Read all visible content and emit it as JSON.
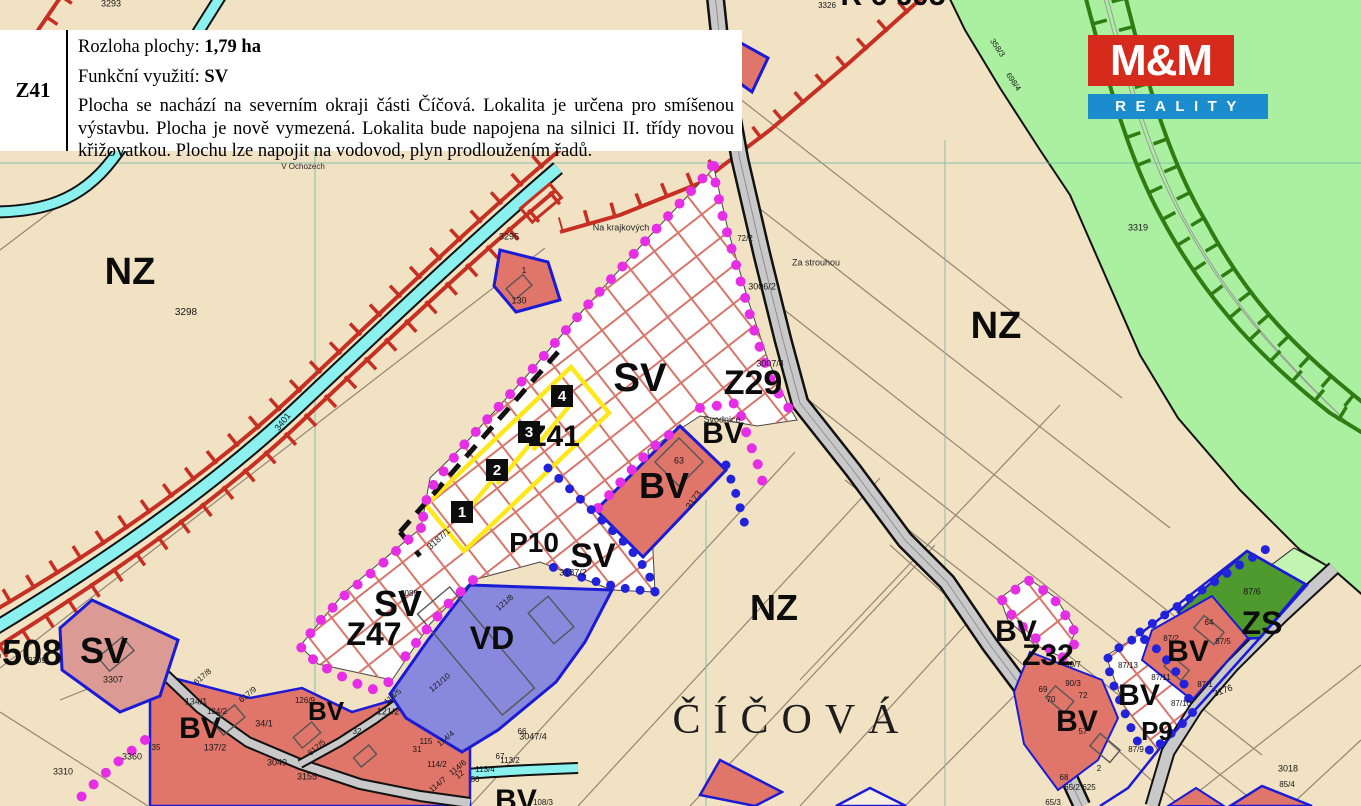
{
  "info_panel": {
    "code": "Z41",
    "area_label": "Rozloha plochy:",
    "area_value": "1,79 ha",
    "use_label": "Funkční využití:",
    "use_value": "SV",
    "desc_lines": [
      "Plocha se nachází na severním okraji části Číčová. Lokalita je určena pro smíšenou",
      "výstavbu. Plocha je nově vymezená. Lokalita bude napojena na silnici II. třídy novou",
      "křižovatkou. Plochu lze napojit na vodovod, plyn prodloužením řadů."
    ]
  },
  "logo": {
    "top": "M&M",
    "bottom": "REALITY",
    "red": "#d62a1c",
    "blue": "#1b8ccd"
  },
  "map": {
    "colors": {
      "background": "#f2e2c4",
      "green_zone": "#abf0a0",
      "zs_green": "#4f9a2e",
      "stream": "#8af1ef",
      "biocorridor_red": "#c62f22",
      "railway_green": "#2e7c12",
      "road_gray": "#c9c9c9",
      "parcel_red": "#e0756a",
      "parcel_pink": "#db9a94",
      "vd_purple": "#8888dd",
      "outline_blue": "#1b1bd6",
      "dots_magenta": "#e62ee6",
      "dots_blue": "#2222dd",
      "plot_yellow": "#ffe81a",
      "hatch_red": "#d7766b"
    },
    "zone_labels": [
      {
        "text": "NZ",
        "x": 130,
        "y": 272,
        "size": 38,
        "name": "zone-label-nz-west"
      },
      {
        "text": "NZ",
        "x": 996,
        "y": 326,
        "size": 38,
        "name": "zone-label-nz-east"
      },
      {
        "text": "NZ",
        "x": 774,
        "y": 608,
        "size": 36,
        "name": "zone-label-nz-south"
      },
      {
        "text": "SV",
        "x": 640,
        "y": 378,
        "size": 40,
        "name": "zone-label-sv-main"
      },
      {
        "text": "Z29",
        "x": 753,
        "y": 383,
        "size": 34,
        "name": "zone-label-z29"
      },
      {
        "text": "Z41",
        "x": 554,
        "y": 437,
        "size": 30,
        "name": "zone-label-z41"
      },
      {
        "text": "BV",
        "x": 723,
        "y": 434,
        "size": 30,
        "name": "zone-label-bv-svodnice"
      },
      {
        "text": "BV",
        "x": 664,
        "y": 486,
        "size": 36,
        "name": "zone-label-bv-center"
      },
      {
        "text": "P10",
        "x": 534,
        "y": 543,
        "size": 28,
        "name": "zone-label-p10"
      },
      {
        "text": "SV",
        "x": 593,
        "y": 556,
        "size": 34,
        "name": "zone-label-sv-p10"
      },
      {
        "text": "SV",
        "x": 398,
        "y": 604,
        "size": 36,
        "name": "zone-label-sv-z47"
      },
      {
        "text": "Z47",
        "x": 374,
        "y": 634,
        "size": 32,
        "name": "zone-label-z47"
      },
      {
        "text": "SV",
        "x": 104,
        "y": 651,
        "size": 36,
        "name": "zone-label-sv-west"
      },
      {
        "text": "-508",
        "x": 26,
        "y": 653,
        "size": 36,
        "name": "zone-label-508"
      },
      {
        "text": "BV",
        "x": 200,
        "y": 729,
        "size": 30,
        "name": "zone-label-bv-village-w"
      },
      {
        "text": "BV",
        "x": 326,
        "y": 711,
        "size": 26,
        "name": "zone-label-bv-village-e"
      },
      {
        "text": "BV",
        "x": 516,
        "y": 801,
        "size": 30,
        "name": "zone-label-bv-bottom"
      },
      {
        "text": "VD",
        "x": 492,
        "y": 638,
        "size": 32,
        "name": "zone-label-vd"
      },
      {
        "text": "BV",
        "x": 1016,
        "y": 632,
        "size": 30,
        "name": "zone-label-bv-z32"
      },
      {
        "text": "Z32",
        "x": 1048,
        "y": 656,
        "size": 30,
        "name": "zone-label-z32"
      },
      {
        "text": "BV",
        "x": 1139,
        "y": 696,
        "size": 30,
        "name": "zone-label-bv-p9"
      },
      {
        "text": "BV",
        "x": 1188,
        "y": 652,
        "size": 30,
        "name": "zone-label-bv-east"
      },
      {
        "text": "BV",
        "x": 1077,
        "y": 722,
        "size": 30,
        "name": "zone-label-bv-se"
      },
      {
        "text": "ZS",
        "x": 1262,
        "y": 623,
        "size": 32,
        "name": "zone-label-zs"
      },
      {
        "text": "P9",
        "x": 1157,
        "y": 731,
        "size": 26,
        "name": "zone-label-p9"
      },
      {
        "text": "R 6 605",
        "x": 893,
        "y": -4,
        "size": 30,
        "name": "zone-label-corridor"
      }
    ],
    "place_labels": [
      {
        "text": "ČÍČOVÁ",
        "x": 792,
        "y": 720,
        "size": 42,
        "cls": "town",
        "name": "town-label-cicova"
      },
      {
        "text": "Svodnice",
        "x": 722,
        "y": 420,
        "size": 9,
        "cls": "place",
        "name": "place-label-svodnice"
      },
      {
        "text": "Na krajkových",
        "x": 621,
        "y": 228,
        "size": 9,
        "cls": "place",
        "name": "place-label-na-krajkovych"
      },
      {
        "text": "Za strouhou",
        "x": 816,
        "y": 263,
        "size": 9,
        "cls": "place",
        "name": "place-label-za-strouhou"
      },
      {
        "text": "V Ochozech",
        "x": 303,
        "y": 167,
        "size": 8,
        "cls": "place",
        "name": "place-label-v-ochozech"
      }
    ],
    "parcel_numbers": [
      {
        "text": "3293",
        "x": 111,
        "y": 4
      },
      {
        "text": "3298",
        "x": 186,
        "y": 313,
        "size": 10
      },
      {
        "text": "3401",
        "x": 283,
        "y": 422,
        "rot": -52
      },
      {
        "text": "3295",
        "x": 509,
        "y": 237
      },
      {
        "text": "1",
        "x": 524,
        "y": 271,
        "size": 8
      },
      {
        "text": "130",
        "x": 519,
        "y": 301
      },
      {
        "text": "72/2",
        "x": 745,
        "y": 239,
        "size": 8
      },
      {
        "text": "3006/2",
        "x": 762,
        "y": 287
      },
      {
        "text": "3007/4",
        "x": 770,
        "y": 364
      },
      {
        "text": "63",
        "x": 679,
        "y": 461
      },
      {
        "text": "3187/2",
        "x": 573,
        "y": 573
      },
      {
        "text": "3187/1",
        "x": 439,
        "y": 539,
        "rot": -42
      },
      {
        "text": "3085",
        "x": 409,
        "y": 594,
        "size": 8
      },
      {
        "text": "3173",
        "x": 694,
        "y": 500,
        "rot": -55
      },
      {
        "text": "3309",
        "x": 37,
        "y": 661,
        "size": 8
      },
      {
        "text": "3307",
        "x": 113,
        "y": 680
      },
      {
        "text": "3310",
        "x": 63,
        "y": 772
      },
      {
        "text": "3360",
        "x": 132,
        "y": 757
      },
      {
        "text": "35",
        "x": 156,
        "y": 748,
        "size": 8
      },
      {
        "text": "134/1",
        "x": 196,
        "y": 702
      },
      {
        "text": "134/2",
        "x": 217,
        "y": 712,
        "size": 8
      },
      {
        "text": "34/1",
        "x": 264,
        "y": 724
      },
      {
        "text": "137/2",
        "x": 215,
        "y": 748
      },
      {
        "text": "3049",
        "x": 277,
        "y": 763
      },
      {
        "text": "126/9",
        "x": 305,
        "y": 701,
        "size": 8
      },
      {
        "text": "121/2",
        "x": 388,
        "y": 712
      },
      {
        "text": "32",
        "x": 357,
        "y": 732,
        "size": 8
      },
      {
        "text": "617/8",
        "x": 203,
        "y": 677,
        "rot": -40,
        "size": 8
      },
      {
        "text": "617/9",
        "x": 248,
        "y": 695,
        "rot": -40,
        "size": 8
      },
      {
        "text": "617/5",
        "x": 317,
        "y": 748,
        "rot": -40,
        "size": 8
      },
      {
        "text": "115",
        "x": 426,
        "y": 742,
        "size": 8
      },
      {
        "text": "31",
        "x": 417,
        "y": 750,
        "size": 8
      },
      {
        "text": "114/4",
        "x": 446,
        "y": 739,
        "rot": -40,
        "size": 8
      },
      {
        "text": "114/5",
        "x": 393,
        "y": 697,
        "rot": -40,
        "size": 8
      },
      {
        "text": "114/2",
        "x": 437,
        "y": 765,
        "size": 8
      },
      {
        "text": "114/6",
        "x": 458,
        "y": 768,
        "rot": -40,
        "size": 8
      },
      {
        "text": "114/7",
        "x": 438,
        "y": 785,
        "rot": -40,
        "size": 8
      },
      {
        "text": "12",
        "x": 460,
        "y": 775,
        "rot": -40,
        "size": 8
      },
      {
        "text": "30",
        "x": 475,
        "y": 780,
        "size": 8
      },
      {
        "text": "113/2",
        "x": 510,
        "y": 761,
        "size": 8
      },
      {
        "text": "113/4",
        "x": 485,
        "y": 770,
        "size": 8
      },
      {
        "text": "66",
        "x": 522,
        "y": 732,
        "size": 8
      },
      {
        "text": "67",
        "x": 500,
        "y": 757,
        "size": 8
      },
      {
        "text": "3047/4",
        "x": 533,
        "y": 737
      },
      {
        "text": "108/3",
        "x": 543,
        "y": 803,
        "size": 8
      },
      {
        "text": "121/8",
        "x": 505,
        "y": 603,
        "rot": -40,
        "size": 8
      },
      {
        "text": "121/10",
        "x": 440,
        "y": 683,
        "rot": -40,
        "size": 8
      },
      {
        "text": "3155",
        "x": 307,
        "y": 777
      },
      {
        "text": "90/7",
        "x": 1073,
        "y": 665,
        "size": 8
      },
      {
        "text": "90/3",
        "x": 1073,
        "y": 684,
        "size": 8
      },
      {
        "text": "69",
        "x": 1043,
        "y": 690,
        "size": 8
      },
      {
        "text": "70",
        "x": 1051,
        "y": 700,
        "size": 8
      },
      {
        "text": "72",
        "x": 1083,
        "y": 696,
        "size": 8
      },
      {
        "text": "57",
        "x": 1083,
        "y": 732,
        "size": 8
      },
      {
        "text": "2",
        "x": 1099,
        "y": 769,
        "size": 8
      },
      {
        "text": "68",
        "x": 1064,
        "y": 778,
        "size": 8
      },
      {
        "text": "87/13",
        "x": 1128,
        "y": 666,
        "size": 8
      },
      {
        "text": "87/11",
        "x": 1161,
        "y": 678,
        "size": 8
      },
      {
        "text": "87/10",
        "x": 1181,
        "y": 704,
        "size": 8
      },
      {
        "text": "87/9",
        "x": 1136,
        "y": 750,
        "size": 8
      },
      {
        "text": "87/2",
        "x": 1171,
        "y": 639,
        "size": 8
      },
      {
        "text": "64",
        "x": 1209,
        "y": 623,
        "size": 8
      },
      {
        "text": "87/5",
        "x": 1223,
        "y": 642,
        "size": 8
      },
      {
        "text": "87/6",
        "x": 1252,
        "y": 592,
        "size": 9
      },
      {
        "text": "87/1",
        "x": 1205,
        "y": 685,
        "size": 8
      },
      {
        "text": "3176",
        "x": 1223,
        "y": 691,
        "rot": -20
      },
      {
        "text": "3018",
        "x": 1288,
        "y": 769
      },
      {
        "text": "3319",
        "x": 1138,
        "y": 228
      },
      {
        "text": "3326",
        "x": 827,
        "y": 6,
        "size": 8
      },
      {
        "text": "65/2",
        "x": 1072,
        "y": 788,
        "size": 8
      },
      {
        "text": "625",
        "x": 1089,
        "y": 788,
        "size": 8
      },
      {
        "text": "65/3",
        "x": 1053,
        "y": 803,
        "size": 8
      },
      {
        "text": "85/4",
        "x": 1287,
        "y": 785,
        "size": 8
      },
      {
        "text": "358/3",
        "x": 997,
        "y": 48,
        "rot": 56,
        "size": 8
      },
      {
        "text": "698/4",
        "x": 1013,
        "y": 82,
        "rot": 56,
        "size": 8
      }
    ],
    "plot_numbers": [
      {
        "text": "1",
        "x": 462,
        "y": 512
      },
      {
        "text": "2",
        "x": 497,
        "y": 470
      },
      {
        "text": "3",
        "x": 529,
        "y": 432
      },
      {
        "text": "4",
        "x": 562,
        "y": 396
      }
    ]
  }
}
